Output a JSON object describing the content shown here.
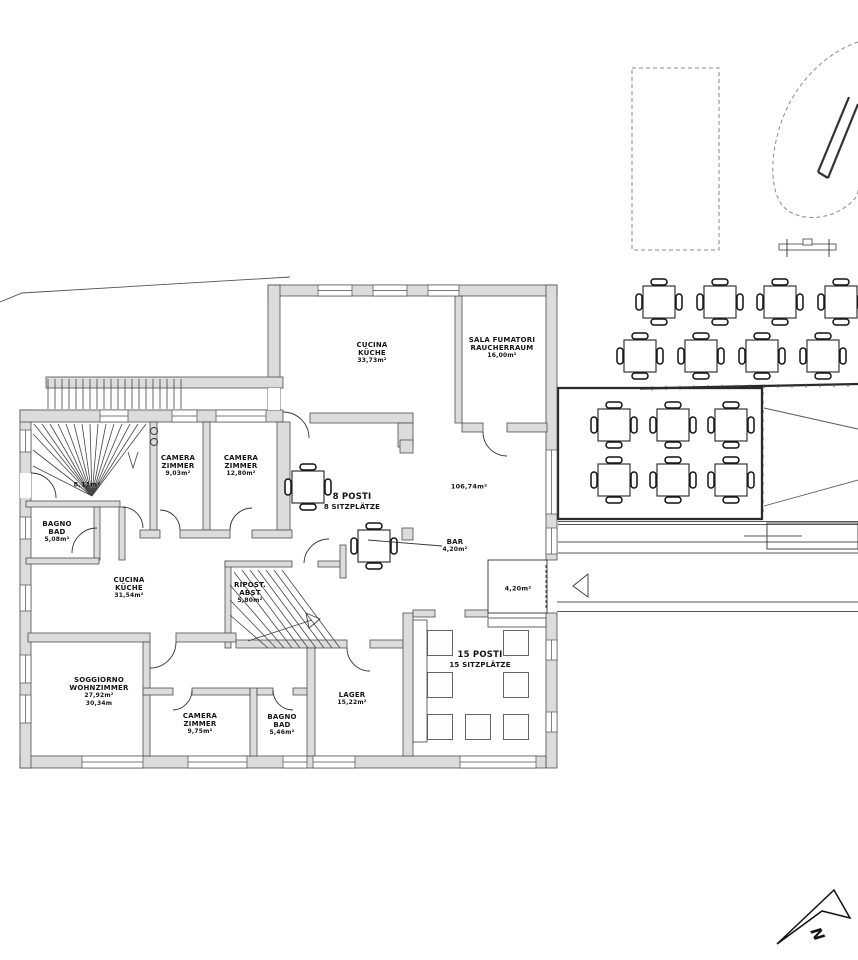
{
  "north_arrow": {
    "label": "N"
  },
  "rooms": {
    "hall": {
      "area": "8,11m²"
    },
    "camera1": {
      "name_it": "CAMERA",
      "name_de": "ZIMMER",
      "area": "9,03m²"
    },
    "camera2": {
      "name_it": "CAMERA",
      "name_de": "ZIMMER",
      "area": "12,80m²"
    },
    "cucina_nord": {
      "name_it": "CUCINA",
      "name_de": "KÜCHE",
      "area": "33,73m²"
    },
    "sala_fumatori": {
      "name_it": "SALA FUMATORI",
      "name_de": "RAUCHERRAUM",
      "area": "16,00m²"
    },
    "dining": {
      "seats_it": "8 POSTI",
      "seats_de": "8 SITZPLÄTZE",
      "area": "106,74m²"
    },
    "bar": {
      "name": "BAR",
      "area": "4,20m²"
    },
    "bagno1": {
      "name_it": "BAGNO",
      "name_de": "BAD",
      "area": "5,08m²"
    },
    "cucina_ovest": {
      "name_it": "CUCINA",
      "name_de": "KÜCHE",
      "area": "31,54m²"
    },
    "ripostiglio": {
      "name_it": "RIPOST.",
      "name_de": "ABST",
      "area": "5,80m²"
    },
    "soggiorno": {
      "name_it": "SOGGIORNO",
      "name_de": "WOHNZIMMER",
      "area": "27,92m²",
      "area2": "30,34m"
    },
    "camera3": {
      "name_it": "CAMERA",
      "name_de": "ZIMMER",
      "area": "9,75m²"
    },
    "bagno2": {
      "name_it": "BAGNO",
      "name_de": "BAD",
      "area": "5,46m²"
    },
    "lager": {
      "name": "LAGER",
      "area": "15,22m²"
    },
    "sala15": {
      "seats_it": "15 POSTI",
      "seats_de": "15 SITZPLÄTZE"
    },
    "vestibolo": {
      "area": "4,20m²"
    }
  }
}
